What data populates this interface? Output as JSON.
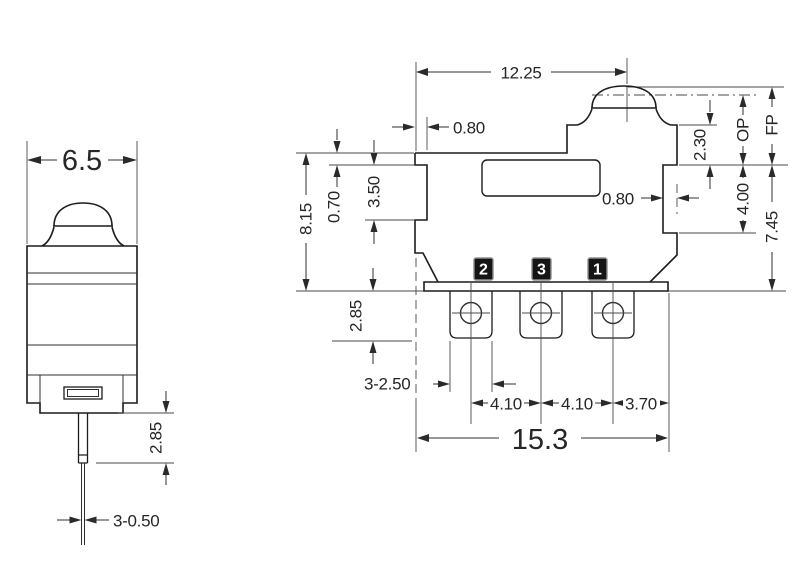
{
  "drawing": {
    "colors": {
      "background": "#ffffff",
      "outline": "#1c1c1c",
      "dimension": "#2a2a2a"
    },
    "left_view": {
      "width": "6.5",
      "pin_length": "2.85",
      "pin_width": "3-0.50"
    },
    "front_view": {
      "plunger_offset": "12.25",
      "top_left_step": "0.80",
      "right_recess": "0.80",
      "plunger_height": "2.30",
      "op_label": "OP",
      "fp_label": "FP",
      "right_step_height": "4.00",
      "body_height_right": "7.45",
      "body_height_left": "8.15",
      "left_notch": "0.70",
      "left_mid": "3.50",
      "terminal_height": "2.85",
      "terminal_width": "3-2.50",
      "terminal_pitch_left": "4.10",
      "terminal_pitch_right": "4.10",
      "terminal_right_offset": "3.70",
      "overall_width": "15.3",
      "terminal_labels": [
        "2",
        "3",
        "1"
      ]
    }
  }
}
